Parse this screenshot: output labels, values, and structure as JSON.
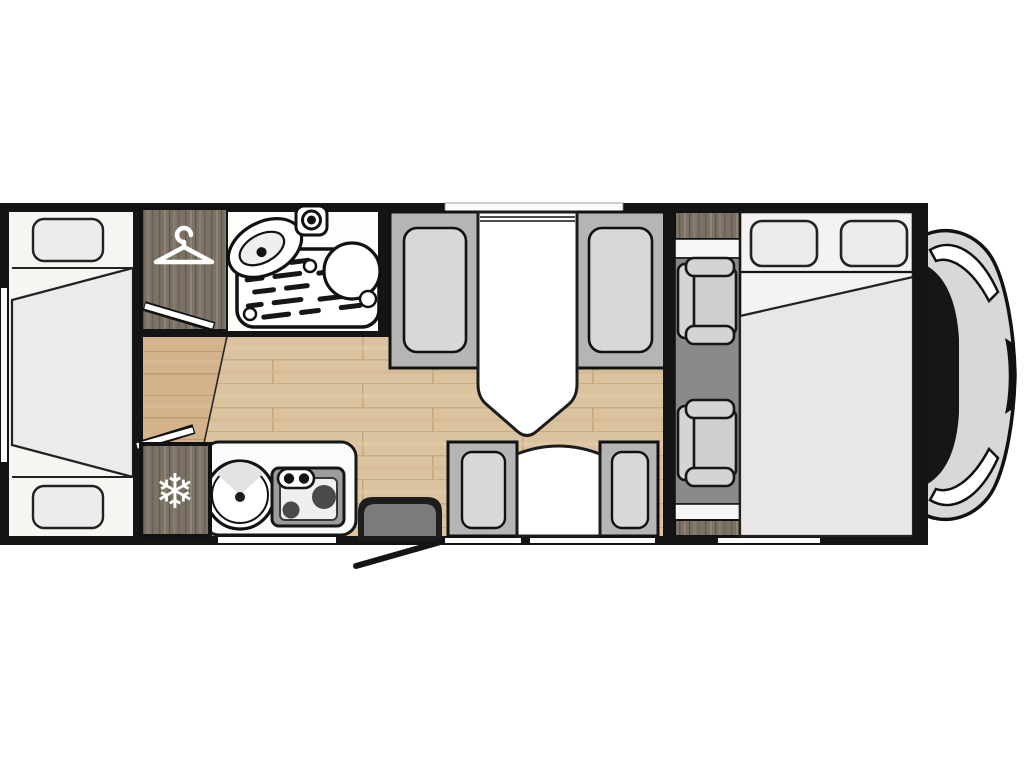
{
  "title": "Motorhome floor plan (top view)",
  "icons": {
    "snowflake_glyph": "❄",
    "snowflake": "snowflake-icon (fridge)",
    "hanger": "hanger-icon (wardrobe)"
  },
  "palette": {
    "wall": "#141414",
    "interior_white": "#f6f5f2",
    "floor_main": "#dcc3a0",
    "floor_plank_line": "#c3a67e",
    "floor_bedroom": "#d3b28c",
    "furniture_wood": "#7b7165",
    "wood_streak_dark": "#645a50",
    "wood_streak_light": "#8e8478",
    "seat_frame_grey": "#b5b5b5",
    "seat_cushion_grey": "#d8d8d8",
    "cab_floor_grey": "#8a8a8a",
    "cab_seat_grey": "#d4d4d4",
    "pillow_grey": "#ebebeb",
    "duvet_grey": "#e8e7e5",
    "step_grey": "#7b7b7b",
    "vehicle_body_grey": "#d8d8d8",
    "windshield_black": "#161616",
    "fixture_white": "#ffffff"
  },
  "features": {
    "rear_bedroom": "rear bed with two pillows and centre duvet",
    "wardrobe": "wardrobe with hanger icon",
    "bathroom": "shower tray, corner sink, mixer, round toilet",
    "dinette_front": "two facing bench seats with table",
    "dinette_side": "two facing seats with small table near entry door",
    "kitchen": "round sink and two-burner hob on counter",
    "fridge": "fridge with snowflake icon",
    "entry": "entry step with open door swing line",
    "cab": "two swivel cab seats",
    "drop_down_bed": "front drop-down double bed with two pillows",
    "vehicle_front": "cab nose with windshield seen from above"
  }
}
